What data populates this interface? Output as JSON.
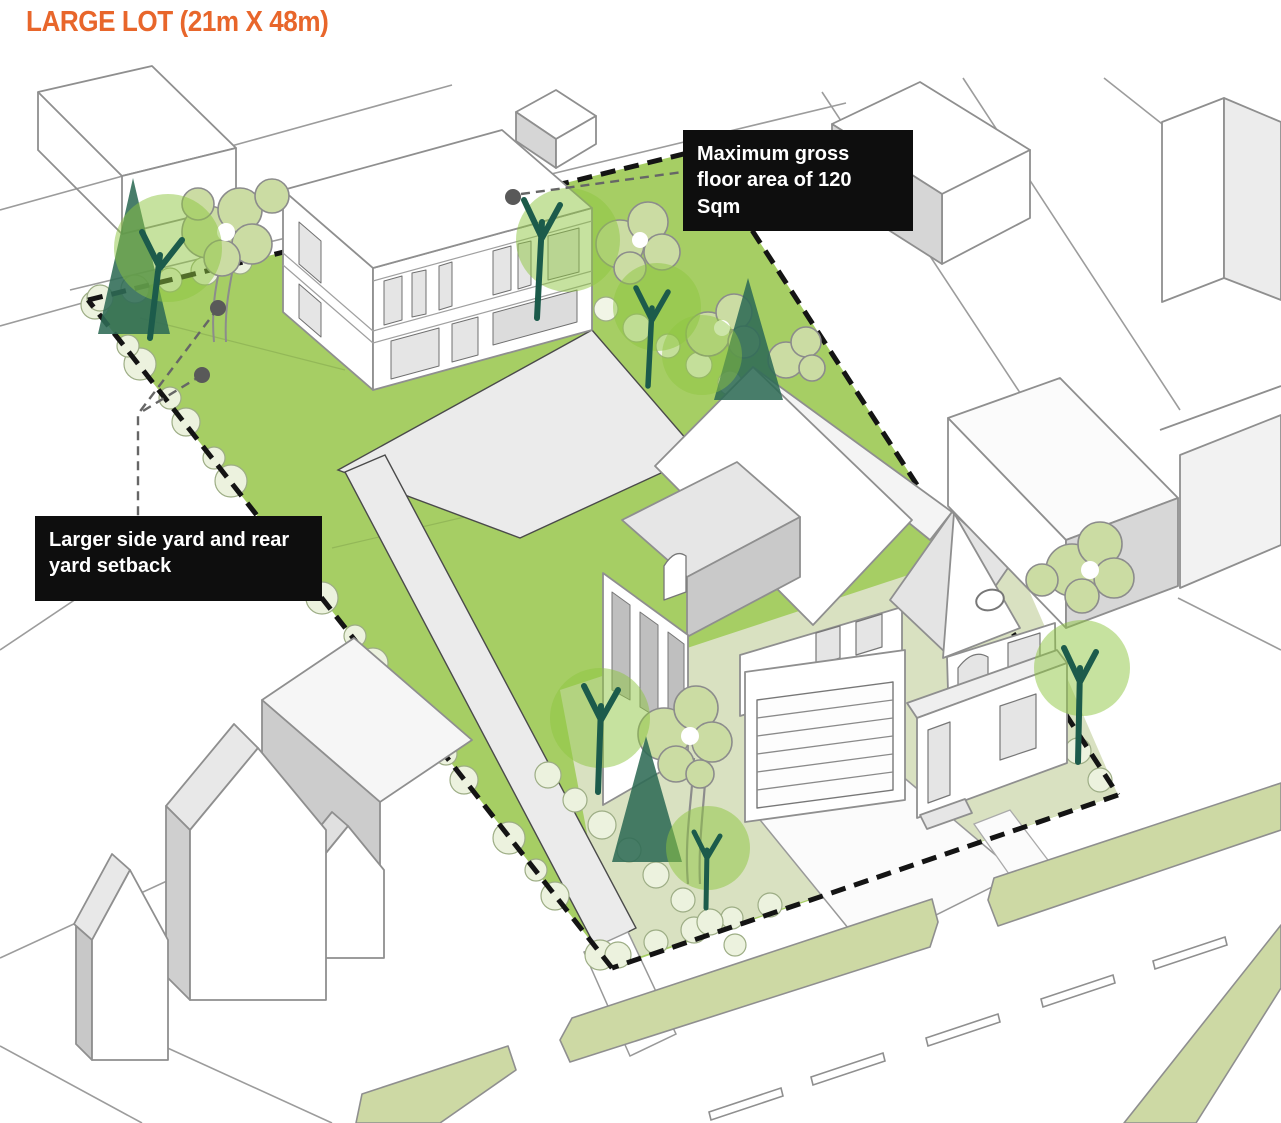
{
  "title": "LARGE LOT (21m X 48m)",
  "callouts": {
    "max_floor_area": {
      "text": "Maximum gross floor area of 120 Sqm"
    },
    "setback": {
      "text": "Larger side yard and rear yard setback"
    }
  },
  "lot": {
    "dimensions": "21m X 48m",
    "type_label": "LARGE LOT"
  },
  "colors": {
    "accent": "#E8662B",
    "callout_bg": "#0E0E0E",
    "callout_fg": "#FFFFFF",
    "lawn": "#A6CE64",
    "front_yard": "#D9E1C1",
    "boulevard": "#CDD9A4",
    "canopy": "#8DC63F",
    "conifer": "#2F6B55",
    "trunk": "#1C5B4B",
    "olive": "#CBDCA3",
    "hedge": "#ECF2DE",
    "hedge_stroke": "#9DAD85",
    "paving": "#EBEBEB",
    "outline": "#8F8F8F",
    "parcel_line": "#9C9C9C",
    "boundary": "#141414",
    "leader": "#666666",
    "window": "#E5E5E5",
    "wall_shade": "#D6D6D6"
  }
}
